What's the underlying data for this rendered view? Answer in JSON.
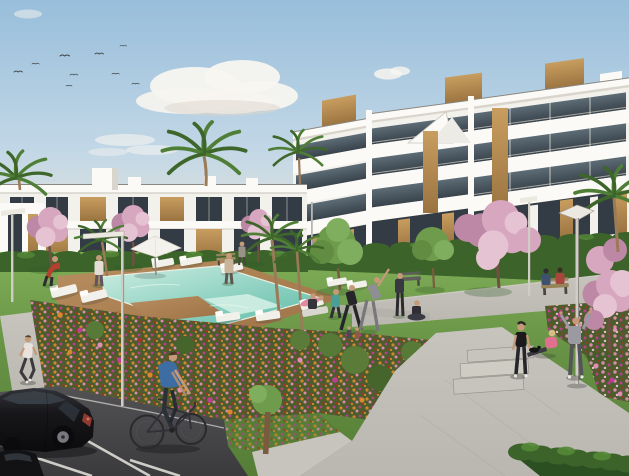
{
  "scene": {
    "type": "architectural_render",
    "description": "Photorealistic 3D exterior rendering of a modern white residential complex on a sunny day: three-storey apartment blocks with glass balconies and wood accents, two-storey terraced houses, a communal turquoise swimming pool with wooden deck and sun loungers, lawns with residents exercising, colorful flower beds, palm and cherry-blossom trees, concrete walkways, street lamps, a parking area with a black car and a cyclist",
    "time_of_day": "day",
    "sky": {
      "birds": 9,
      "clouds": 4
    }
  },
  "colors": {
    "sky_top": "#98bedb",
    "sky_mid": "#c2d7e6",
    "sky_low": "#e9e5d9",
    "cloud": "#f7f5f0",
    "building": "#f3f1ec",
    "building_bright": "#fbfaf6",
    "building_shade": "#d9d5cc",
    "fascia": "#c9c5bc",
    "glass_top": "#5d6c76",
    "glass_bottom": "#39434b",
    "glass_dark": "#333c44",
    "mullion": "#eceae2",
    "wood_light": "#c89d5f",
    "wood_dark": "#9a7340",
    "lawn_light": "#7fae57",
    "lawn": "#679245",
    "lawn_dark": "#557d36",
    "hedge": "#3c6329",
    "hedge_light": "#548836",
    "hedge_dark": "#2c4f21",
    "blossom": "#d7a6bf",
    "blossom_light": "#e6c3d2",
    "blossom_dark": "#bd88a6",
    "palm": "#4f7f37",
    "palm_dark": "#3e662b",
    "trunk": "#8a6a4c",
    "pool_light": "#cdeee2",
    "pool_deep": "#58b8a4",
    "deck_light": "#b88f60",
    "deck_dark": "#9c7044",
    "path": "#b9b7af",
    "path_light": "#c6c4bc",
    "path_dark": "#9c9a92",
    "road_light": "#525154",
    "road_dark": "#3b3a3c",
    "line_white": "#e8e6e0",
    "bed_base": "#4d5c2c",
    "flower_orange": "#d6892f",
    "flower_magenta": "#bb3f92",
    "flower_pink": "#df8fb4",
    "flower_red": "#a33528",
    "car_body": "#17171a",
    "car_glass": "#3a4148",
    "pole": "#cfcdc5",
    "lamp_head": "#ece9e1",
    "skin": "#c49a78",
    "shadow_grass": "#2f5a26",
    "shadow_hard": "#222222",
    "bike_blue": "#3e6da4"
  },
  "objects": {
    "buildings": [
      {
        "label": "three-storey apartment block",
        "position": "right",
        "features": [
          "white facade",
          "glass balcony railings",
          "dark glazing bands",
          "vertical wood panels",
          "roof boxes"
        ]
      },
      {
        "label": "two-storey terraced houses",
        "position": "left",
        "features": [
          "white facade",
          "wood slat panels",
          "roof parapets"
        ]
      }
    ],
    "pool": {
      "label": "communal swimming pool",
      "water": "turquoise",
      "deck": "wood",
      "sun_loungers": 10,
      "parasols": 1
    },
    "vegetation": {
      "palm_trees": 7,
      "blossom_trees": 5,
      "green_trees": 3,
      "hedges": 3,
      "flower_beds": 5
    },
    "street_furniture": {
      "street_lamps": 4,
      "benches": 3,
      "steps": 3
    },
    "vehicles": [
      {
        "label": "black hatchback parked in marked bay"
      },
      {
        "label": "dark car at bottom-left corner"
      },
      {
        "label": "bicycle with rider"
      }
    ],
    "people": [
      "jogger on left sidewalk",
      "cyclist on road",
      "person in red by pool",
      "person in white/pink by pool",
      "person in beige by pool",
      "resident walking near bench",
      "person seated on exercise mat",
      "woman in teal exercising",
      "person in black exercising",
      "person in grey stretching",
      "person in dark standing",
      "person seated in yoga pose",
      "two small figures on lawn",
      "two people seated on bench",
      "woman in black sportswear on path",
      "woman in pink sitting stretching",
      "person in grey hoodie raising arms",
      "person sunbathing on lounger"
    ],
    "animals": [
      "small black dog near path"
    ]
  }
}
